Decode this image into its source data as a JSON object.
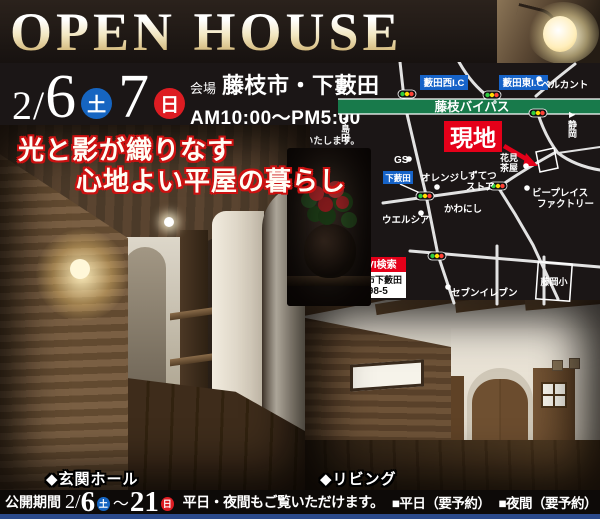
{
  "header": {
    "title": "OPEN HOUSE"
  },
  "event": {
    "date_prefix": "2/",
    "day1_num": "6",
    "day1": "土",
    "day2_num": "7",
    "day2": "日",
    "venue_label": "会場",
    "venue": "藤枝市・下藪田",
    "time": "AM10:00〜PM5:00",
    "note": "お客様のご厚意により開催いたします。"
  },
  "catch": {
    "line1": "光と影が織りなす",
    "line2": "心地よい平屋の暮らし"
  },
  "map": {
    "ic_west": "藪田西I.C",
    "ic_east": "藪田東I.C",
    "bypass": "藤枝バイパス",
    "site": "現地",
    "belcanto": "ベルカント",
    "gs": "GS",
    "shimoyabuta": "下藪田",
    "orange": "オレンジ",
    "shizutetsu1": "しずてつ",
    "shizutetsu2": "ストア",
    "kawanishi": "かわにし",
    "bplace1": "ビープレイス",
    "bplace2": "ファクトリー",
    "welcia": "ウエルシア",
    "hanami1": "花見",
    "hanami2": "茶屋",
    "seven": "セブンイレブン",
    "school": "藤岡小",
    "arrow_west": "◀",
    "shimada": "島田",
    "arrow_east": "▶",
    "shizuoka": "静岡",
    "navi": "NAVI検索",
    "addr1": "藤枝市下藪田",
    "addr2": "398-5"
  },
  "photos": {
    "entrance_caption": "◆玄関ホール",
    "living_caption": "◆リビング"
  },
  "footer": {
    "label": "公開期間",
    "date1_prefix": "2/",
    "date1_num": "6",
    "day1": "土",
    "tilde": "〜",
    "date2": "21",
    "day2": "日",
    "message": "平日・夜間もご覧いただけます。",
    "weekday": "■平日（要予約）",
    "night": "■夜間（要予約）"
  },
  "colors": {
    "accent_red": "#e50019",
    "map_blue": "#1663c8",
    "bypass_green": "#187a4b",
    "day_blue": "#1665c1",
    "day_red": "#dd1c22",
    "footer_blue": "#2b4a8b"
  }
}
